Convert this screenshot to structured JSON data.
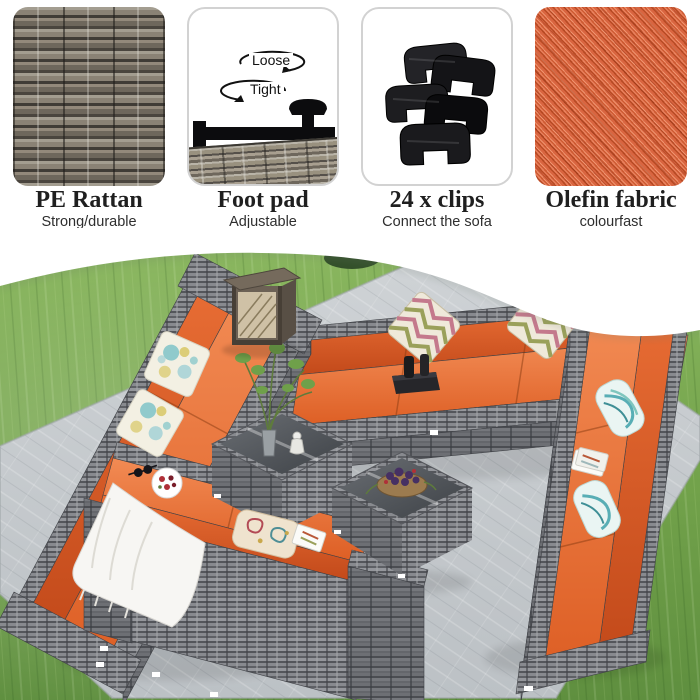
{
  "features": {
    "items": [
      {
        "title": "PE Rattan",
        "subtitle": "Strong/durable",
        "image": "rattan-texture"
      },
      {
        "title": "Foot pad",
        "subtitle": "Adjustable",
        "image": "footpad-diagram",
        "arrow_labels": {
          "loose": "Loose",
          "tight": "Tight"
        }
      },
      {
        "title": "24 x clips",
        "subtitle": "Connect the sofa",
        "subtitle2": "Prevents movemen",
        "image": "clips-photo"
      },
      {
        "title": "Olefin fabric",
        "subtitle": "colourfast",
        "image": "olefin-texture"
      }
    ]
  },
  "scene_icons": [
    "sofa-set",
    "patio-mat",
    "grass-lawn",
    "lantern",
    "coffee-table",
    "throw-pillows",
    "throw-blanket"
  ],
  "colors": {
    "accent_orange": "#E8662F",
    "cushion_orange_dark": "#C2491A",
    "rattan_gray": "#7E8085",
    "grass_green": "#74A24E",
    "mat_gray": "#C6CACD",
    "lantern_bronze": "#6B6054",
    "clip_black": "#1A1A1C",
    "text_dark": "#222222",
    "white": "#FFFFFF"
  }
}
